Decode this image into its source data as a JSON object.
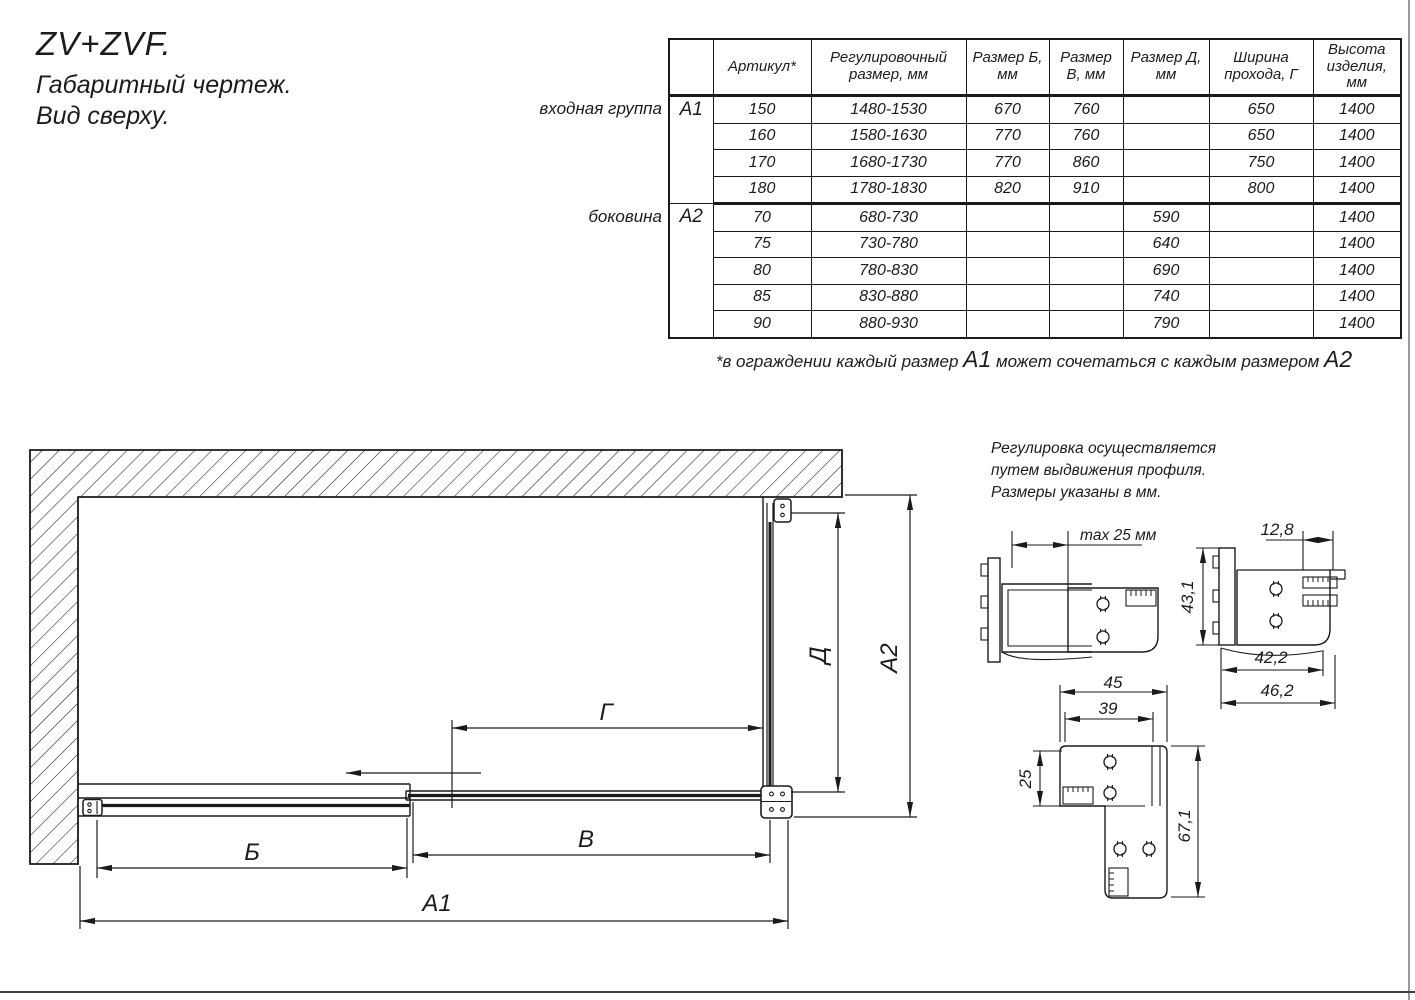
{
  "page": {
    "title_line1": "ZV+ZVF.",
    "title_line2": "Габаритный чертеж.",
    "title_line3": "Вид сверху."
  },
  "table": {
    "col_headers": [
      "Артикул*",
      "Регулировочный размер, мм",
      "Размер Б, мм",
      "Размер В, мм",
      "Размер Д, мм",
      "Ширина прохода, Г",
      "Высота изделия, мм"
    ],
    "groups": [
      {
        "label": "входная группа",
        "code": "А1",
        "rows": [
          {
            "art": "150",
            "reg": "1480-1530",
            "b": "670",
            "v": "760",
            "d": "",
            "g": "650",
            "h": "1400"
          },
          {
            "art": "160",
            "reg": "1580-1630",
            "b": "770",
            "v": "760",
            "d": "",
            "g": "650",
            "h": "1400"
          },
          {
            "art": "170",
            "reg": "1680-1730",
            "b": "770",
            "v": "860",
            "d": "",
            "g": "750",
            "h": "1400"
          },
          {
            "art": "180",
            "reg": "1780-1830",
            "b": "820",
            "v": "910",
            "d": "",
            "g": "800",
            "h": "1400"
          }
        ]
      },
      {
        "label": "боковина",
        "code": "А2",
        "rows": [
          {
            "art": "70",
            "reg": "680-730",
            "b": "",
            "v": "",
            "d": "590",
            "g": "",
            "h": "1400"
          },
          {
            "art": "75",
            "reg": "730-780",
            "b": "",
            "v": "",
            "d": "640",
            "g": "",
            "h": "1400"
          },
          {
            "art": "80",
            "reg": "780-830",
            "b": "",
            "v": "",
            "d": "690",
            "g": "",
            "h": "1400"
          },
          {
            "art": "85",
            "reg": "830-880",
            "b": "",
            "v": "",
            "d": "740",
            "g": "",
            "h": "1400"
          },
          {
            "art": "90",
            "reg": "880-930",
            "b": "",
            "v": "",
            "d": "790",
            "g": "",
            "h": "1400"
          }
        ]
      }
    ],
    "footnote": {
      "pre": "*в ограждении каждый размер ",
      "a1": "А1",
      "mid": " может сочетаться с каждым размером ",
      "a2": "А2"
    }
  },
  "note": {
    "line1": "Регулировка осуществляется",
    "line2": "путем выдвижения профиля.",
    "line3": "Размеры указаны в мм."
  },
  "dims": {
    "b": "Б",
    "v": "В",
    "a1": "А1",
    "g": "Г",
    "d": "Д",
    "a2": "А2"
  },
  "details": {
    "max25": "max 25 мм",
    "w128": "12,8",
    "h431": "43,1",
    "w422": "42,2",
    "w462": "46,2",
    "w45": "45",
    "w39": "39",
    "h25": "25",
    "h671": "67,1"
  },
  "colors": {
    "ink": "#1a1a1a",
    "paper": "#ffffff"
  }
}
